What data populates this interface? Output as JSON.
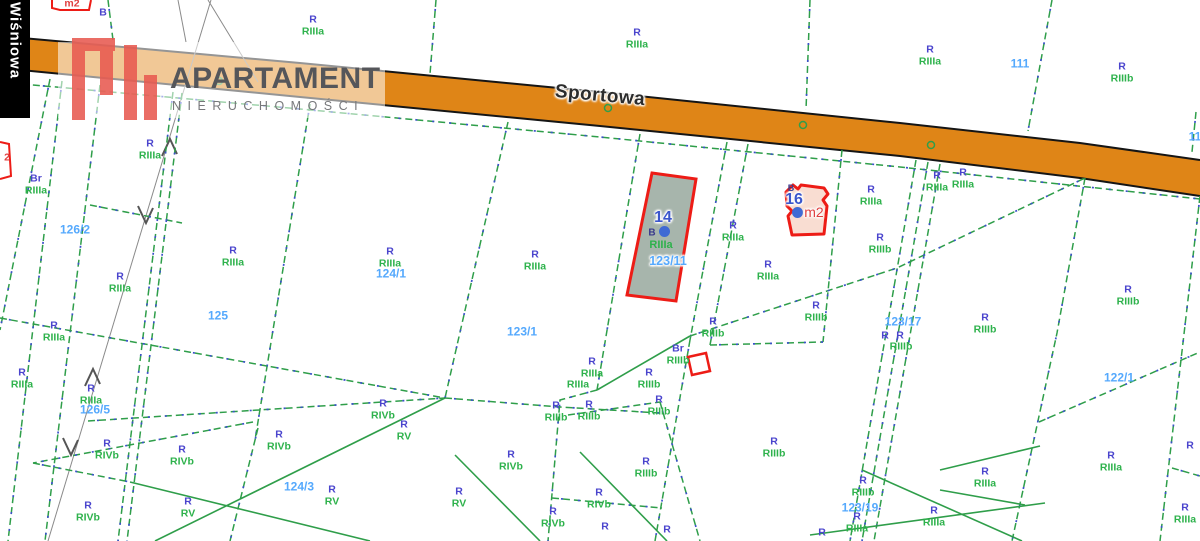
{
  "watermark": {
    "title": "APARTAMENT",
    "subtitle": "NIERUCHOMOŚCI"
  },
  "streets": {
    "main_road": "Sportowa",
    "side_street": "Wiśniowa"
  },
  "highlights": [
    {
      "id": "14",
      "building_mark": "B",
      "soil_class": "RIIIa",
      "parcel_number": "123/11"
    },
    {
      "id": "16",
      "building_mark": "B",
      "area_unit": "m2"
    }
  ],
  "map": {
    "colors": {
      "use_label": "#4a44cd",
      "soil_label": "#2eb24c",
      "parcel_number": "#55a9fd",
      "road_fill": "#df8517",
      "road_edge": "#151515",
      "boundary_green": "#2f9e4a",
      "boundary_blue": "#3b51c9",
      "survey_gray": "#8a8a8a",
      "highlight_border": "#ed1c16",
      "parcel14_fill": "#a7b5ac",
      "parcel16_fill": "#f9ddd2",
      "point_blue": "#3f6ad4",
      "red_text": "#e04040",
      "logo_red": "#e85a50",
      "logo_text": "#55565a",
      "logo_sub": "#77787b"
    },
    "road": {
      "top_edge": [
        0,
        36,
        300,
        63,
        600,
        92,
        900,
        123,
        1080,
        143,
        1200,
        160
      ],
      "bottom_edge": [
        0,
        68,
        300,
        97,
        600,
        126,
        900,
        156,
        1080,
        178,
        1200,
        196
      ]
    },
    "soil_labels": [
      {
        "x": 313,
        "y": 26,
        "a": "R",
        "b": "RIIIa"
      },
      {
        "x": 637,
        "y": 39,
        "a": "R",
        "b": "RIIIa"
      },
      {
        "x": 930,
        "y": 56,
        "a": "R",
        "b": "RIIIa"
      },
      {
        "x": 1122,
        "y": 73,
        "a": "R",
        "b": "RIIIb"
      },
      {
        "x": 36,
        "y": 185,
        "a": "Br",
        "b": "RIIIa"
      },
      {
        "x": 150,
        "y": 150,
        "a": "R",
        "b": "RIIIa"
      },
      {
        "x": 120,
        "y": 283,
        "a": "R",
        "b": "RIIIa"
      },
      {
        "x": 233,
        "y": 257,
        "a": "R",
        "b": "RIIIa"
      },
      {
        "x": 54,
        "y": 332,
        "a": "R",
        "b": "RIIIa"
      },
      {
        "x": 22,
        "y": 379,
        "a": "R",
        "b": "RIIIa"
      },
      {
        "x": 91,
        "y": 395,
        "a": "R",
        "b": "RIIIa"
      },
      {
        "x": 107,
        "y": 450,
        "a": "R",
        "b": "RIVb"
      },
      {
        "x": 182,
        "y": 456,
        "a": "R",
        "b": "RIVb"
      },
      {
        "x": 279,
        "y": 441,
        "a": "R",
        "b": "RIVb"
      },
      {
        "x": 88,
        "y": 512,
        "a": "R",
        "b": "RIVb"
      },
      {
        "x": 188,
        "y": 508,
        "a": "R",
        "b": "RV"
      },
      {
        "x": 332,
        "y": 496,
        "a": "R",
        "b": "RV"
      },
      {
        "x": 390,
        "y": 258,
        "a": "R",
        "b": "RIIIa"
      },
      {
        "x": 535,
        "y": 261,
        "a": "R",
        "b": "RIIIa"
      },
      {
        "x": 404,
        "y": 431,
        "a": "R",
        "b": "RV"
      },
      {
        "x": 383,
        "y": 410,
        "a": "R",
        "b": "RIVb"
      },
      {
        "x": 511,
        "y": 461,
        "a": "R",
        "b": "RIVb"
      },
      {
        "x": 459,
        "y": 498,
        "a": "R",
        "b": "RV"
      },
      {
        "x": 556,
        "y": 412,
        "a": "R",
        "b": "RIIIb"
      },
      {
        "x": 589,
        "y": 411,
        "a": "R",
        "b": "RIIIb"
      },
      {
        "x": 659,
        "y": 406,
        "a": "R",
        "b": "RIIIb"
      },
      {
        "x": 592,
        "y": 368,
        "a": "R",
        "b": "RIIIa"
      },
      {
        "x": 713,
        "y": 328,
        "a": "R",
        "b": "RIIIb"
      },
      {
        "x": 678,
        "y": 355,
        "a": "Br",
        "b": "RIIIb"
      },
      {
        "x": 649,
        "y": 379,
        "a": "R",
        "b": "RIIIb"
      },
      {
        "x": 553,
        "y": 518,
        "a": "R",
        "b": "RIVb"
      },
      {
        "x": 599,
        "y": 499,
        "a": "R",
        "b": "RIVb"
      },
      {
        "x": 646,
        "y": 468,
        "a": "R",
        "b": "RIIIb"
      },
      {
        "x": 774,
        "y": 448,
        "a": "R",
        "b": "RIIIb"
      },
      {
        "x": 768,
        "y": 271,
        "a": "R",
        "b": "RIIIa"
      },
      {
        "x": 733,
        "y": 232,
        "a": "R",
        "b": "RIIIa"
      },
      {
        "x": 816,
        "y": 312,
        "a": "R",
        "b": "RIIIb"
      },
      {
        "x": 871,
        "y": 196,
        "a": "R",
        "b": "RIIIa"
      },
      {
        "x": 937,
        "y": 182,
        "a": "R",
        "b": "RIIIa"
      },
      {
        "x": 963,
        "y": 179,
        "a": "R",
        "b": "RIIIa"
      },
      {
        "x": 880,
        "y": 244,
        "a": "R",
        "b": "RIIIb"
      },
      {
        "x": 985,
        "y": 324,
        "a": "R",
        "b": "RIIIb"
      },
      {
        "x": 1128,
        "y": 296,
        "a": "R",
        "b": "RIIIb"
      },
      {
        "x": 863,
        "y": 487,
        "a": "R",
        "b": "RIIIb"
      },
      {
        "x": 857,
        "y": 523,
        "a": "R",
        "b": "RIIIa"
      },
      {
        "x": 934,
        "y": 517,
        "a": "R",
        "b": "RIIIa"
      },
      {
        "x": 985,
        "y": 478,
        "a": "R",
        "b": "RIIIa"
      },
      {
        "x": 1111,
        "y": 462,
        "a": "R",
        "b": "RIIIa"
      },
      {
        "x": 1185,
        "y": 514,
        "a": "R",
        "b": "RIIIa"
      }
    ],
    "single_labels": [
      {
        "x": 103,
        "y": 13,
        "t": "B",
        "c": "blue"
      },
      {
        "x": 578,
        "y": 385,
        "t": "RIIIa",
        "c": "green"
      },
      {
        "x": 885,
        "y": 336,
        "t": "R",
        "c": "blue"
      },
      {
        "x": 900,
        "y": 336,
        "t": "R",
        "c": "blue"
      },
      {
        "x": 901,
        "y": 347,
        "t": "RIIIb",
        "c": "green"
      },
      {
        "x": 605,
        "y": 527,
        "t": "R",
        "c": "blue"
      },
      {
        "x": 667,
        "y": 530,
        "t": "R",
        "c": "blue"
      },
      {
        "x": 822,
        "y": 533,
        "t": "R",
        "c": "blue"
      },
      {
        "x": 1190,
        "y": 446,
        "t": "R",
        "c": "blue"
      },
      {
        "x": 72,
        "y": 4,
        "t": "m2",
        "c": "red"
      },
      {
        "x": 7,
        "y": 158,
        "t": "2",
        "c": "red"
      }
    ],
    "parcel_numbers": [
      {
        "x": 1020,
        "y": 64,
        "n": "111"
      },
      {
        "x": 1195,
        "y": 137,
        "n": "11"
      },
      {
        "x": 75,
        "y": 230,
        "n": "126/2"
      },
      {
        "x": 218,
        "y": 316,
        "n": "125"
      },
      {
        "x": 391,
        "y": 274,
        "n": "124/1"
      },
      {
        "x": 522,
        "y": 332,
        "n": "123/1"
      },
      {
        "x": 95,
        "y": 410,
        "n": "126/5"
      },
      {
        "x": 299,
        "y": 487,
        "n": "124/3"
      },
      {
        "x": 903,
        "y": 322,
        "n": "123/17"
      },
      {
        "x": 860,
        "y": 508,
        "n": "123/19"
      },
      {
        "x": 1119,
        "y": 378,
        "n": "122/1"
      }
    ],
    "lines": {
      "dashed": [
        [
          108,
          0,
          113,
          40
        ],
        [
          436,
          0,
          430,
          74
        ],
        [
          1052,
          0,
          1028,
          131
        ],
        [
          810,
          0,
          806,
          110
        ],
        [
          1196,
          112,
          1192,
          152
        ],
        [
          0,
          82,
          300,
          109,
          600,
          137,
          900,
          167,
          1200,
          199
        ],
        [
          50,
          79,
          0,
          330
        ],
        [
          62,
          81,
          8,
          541
        ],
        [
          100,
          85,
          45,
          541
        ],
        [
          173,
          92,
          118,
          541
        ],
        [
          182,
          93,
          127,
          541
        ],
        [
          310,
          104,
          255,
          440
        ],
        [
          258,
          428,
          230,
          541
        ],
        [
          508,
          122,
          445,
          398
        ],
        [
          640,
          134,
          597,
          390
        ],
        [
          597,
          390,
          560,
          400,
          548,
          541
        ],
        [
          727,
          142,
          690,
          340
        ],
        [
          748,
          144,
          710,
          345
        ],
        [
          842,
          150,
          823,
          342
        ],
        [
          916,
          160,
          850,
          541
        ],
        [
          928,
          162,
          862,
          541
        ],
        [
          940,
          164,
          874,
          541
        ],
        [
          1085,
          178,
          1057,
          333,
          1012,
          541
        ],
        [
          1200,
          196,
          1160,
          541
        ],
        [
          1172,
          468,
          1200,
          476
        ],
        [
          90,
          205,
          182,
          223
        ],
        [
          0,
          318,
          445,
          398
        ],
        [
          88,
          421,
          445,
          398
        ],
        [
          33,
          463,
          130,
          482
        ],
        [
          253,
          422,
          33,
          463
        ],
        [
          445,
          398,
          560,
          407,
          660,
          413
        ],
        [
          690,
          340,
          655,
          541
        ],
        [
          710,
          345,
          823,
          342
        ],
        [
          690,
          336,
          897,
          268,
          1085,
          178
        ],
        [
          568,
          415,
          660,
          402
        ],
        [
          660,
          402,
          700,
          541
        ],
        [
          552,
          498,
          662,
          508
        ],
        [
          1039,
          422,
          1200,
          352
        ]
      ],
      "solid": [
        [
          445,
          398,
          155,
          541
        ],
        [
          130,
          482,
          370,
          541
        ],
        [
          580,
          452,
          667,
          541
        ],
        [
          810,
          535,
          1045,
          503
        ],
        [
          862,
          470,
          1022,
          541
        ],
        [
          597,
          390,
          690,
          336
        ],
        [
          940,
          470,
          1040,
          446
        ],
        [
          940,
          490,
          1025,
          505
        ],
        [
          455,
          455,
          540,
          541
        ]
      ],
      "survey": [
        [
          211,
          0,
          48,
          541
        ],
        [
          178,
          0,
          186,
          42
        ],
        [
          208,
          0,
          258,
          82
        ]
      ]
    },
    "arrows": [
      {
        "x": 170,
        "y": 142,
        "dir": "up"
      },
      {
        "x": 146,
        "y": 220,
        "dir": "down"
      },
      {
        "x": 93,
        "y": 372,
        "dir": "up"
      },
      {
        "x": 71,
        "y": 452,
        "dir": "down"
      }
    ],
    "circles": [
      [
        13,
        57
      ],
      [
        219,
        81
      ],
      [
        608,
        108
      ],
      [
        803,
        125
      ],
      [
        931,
        145
      ]
    ],
    "dots": [
      [
        664,
        231
      ],
      [
        797,
        212
      ]
    ],
    "shapes": {
      "parcel14": [
        652,
        173,
        696,
        179,
        676,
        301,
        627,
        295
      ],
      "parcel16": [
        786,
        192,
        793,
        185,
        798,
        189,
        801,
        185,
        824,
        188,
        828,
        194,
        823,
        200,
        827,
        206,
        824,
        234,
        792,
        235,
        788,
        216,
        792,
        211,
        787,
        206
      ],
      "br_square": [
        688,
        357,
        706,
        353,
        710,
        371,
        692,
        375
      ],
      "top_building": [
        52,
        0,
        52,
        8,
        60,
        10,
        89,
        10,
        91,
        0
      ],
      "left_building": [
        0,
        142,
        9,
        144,
        11,
        176,
        0,
        179
      ]
    }
  }
}
